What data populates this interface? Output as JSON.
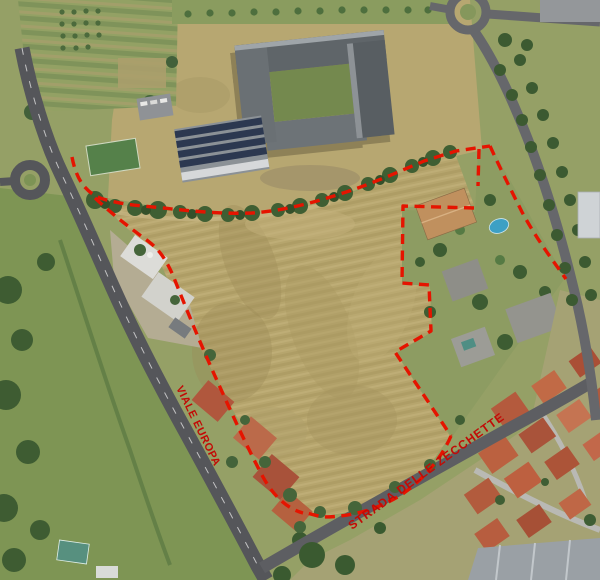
{
  "map": {
    "kind": "aerial-photo-with-site-annotation",
    "street_labels": [
      {
        "id": "viale-europa",
        "text": "VIALE EUROPA"
      },
      {
        "id": "strada-delle-zecchette",
        "text": "STRADA DELLE ZECCHETTE"
      }
    ],
    "annotations": {
      "site_boundary": {
        "style": "dashed",
        "color": "#e51400"
      }
    },
    "colors": {
      "boundary_red": "#e51400",
      "label_red": "#c20b06",
      "field_tan": "#b6a56d",
      "grass_green": "#7e9554",
      "tree_green": "#3f5f33",
      "road_gray": "#55565a",
      "roof_red": "#b45a3d",
      "pool_blue": "#3da0c4",
      "school_roof_gray": "#5f6569",
      "solar_panel_blue": "#2c3850"
    }
  }
}
